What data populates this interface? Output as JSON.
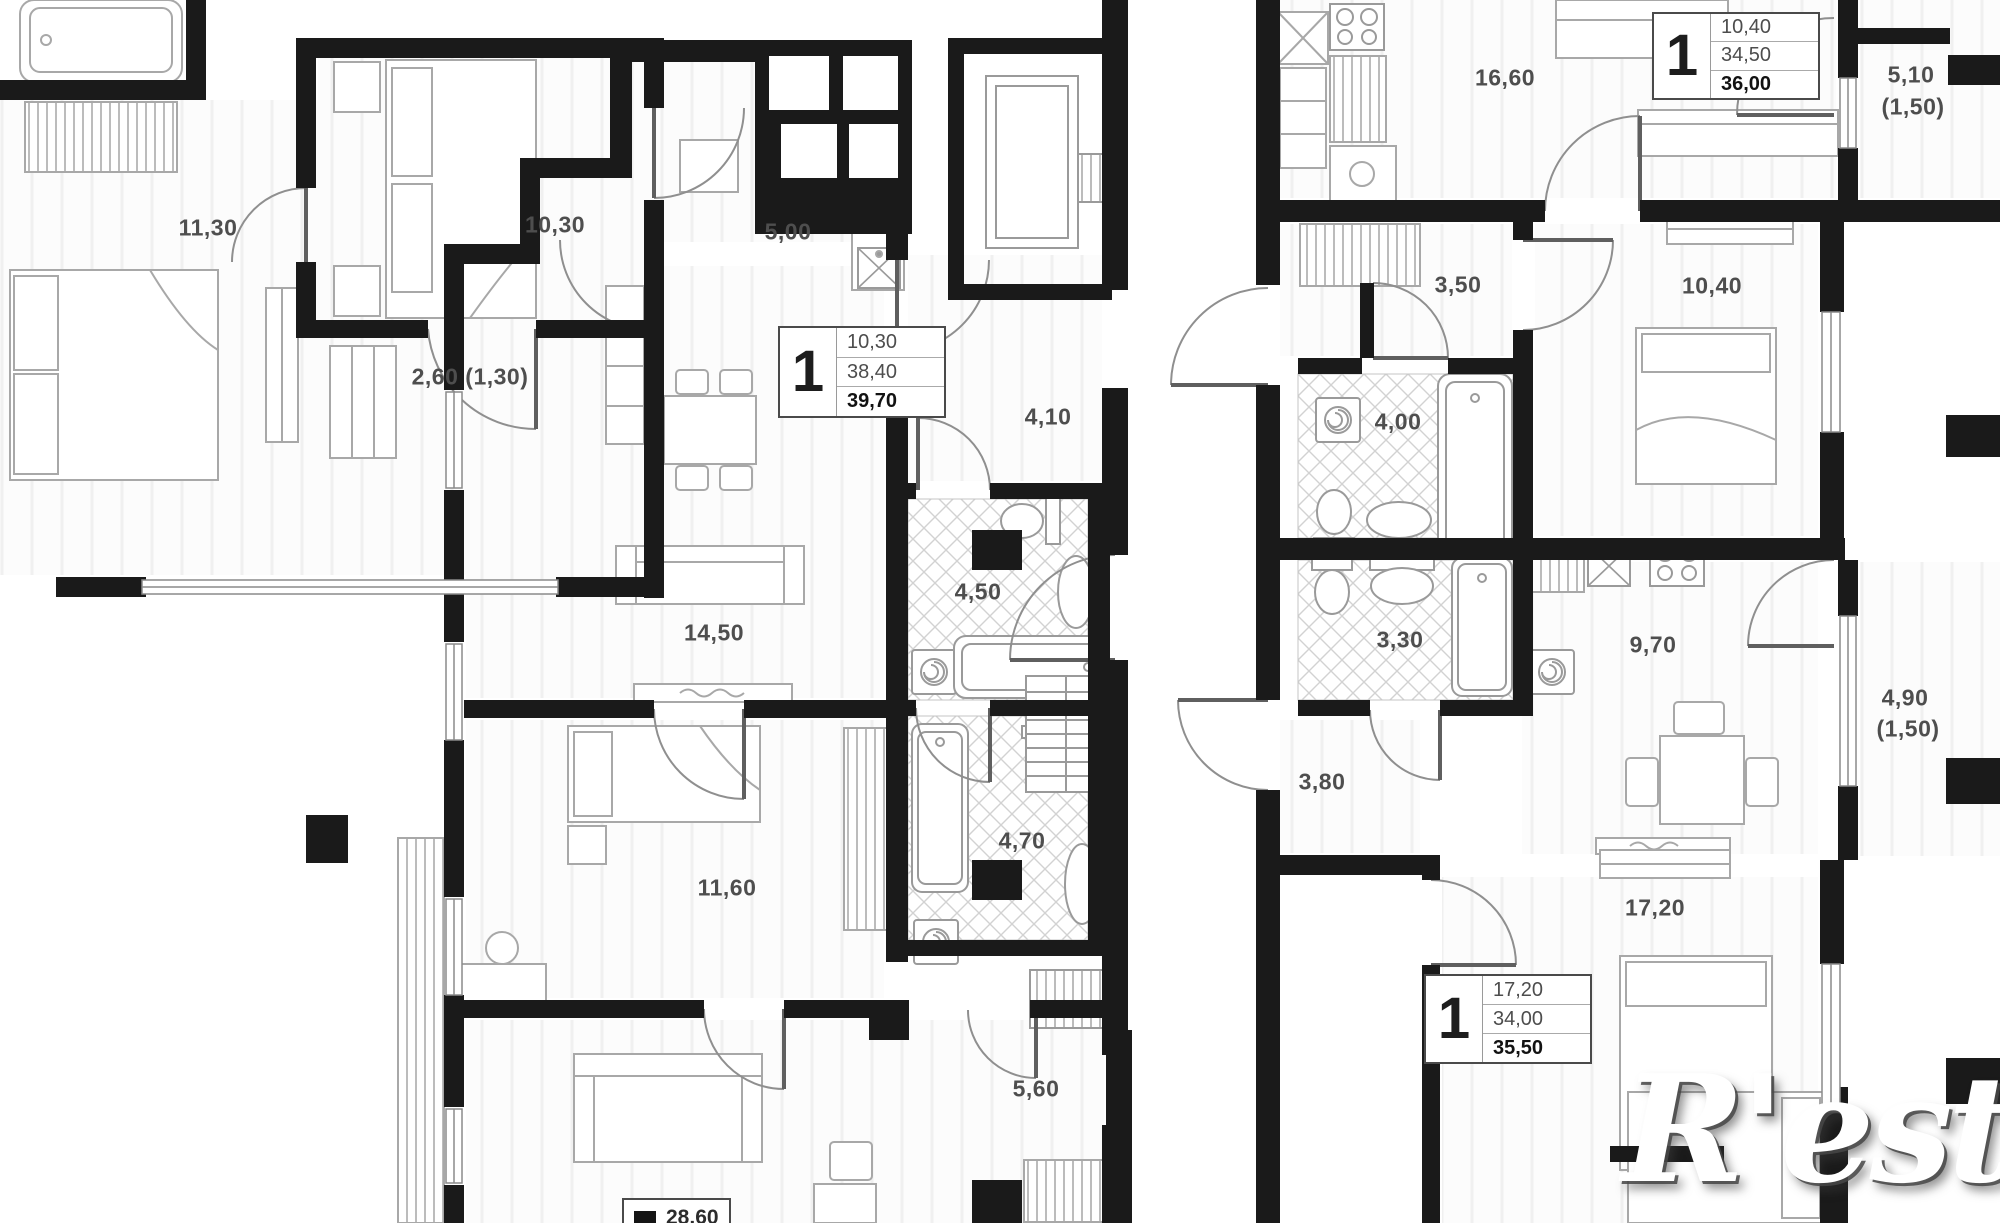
{
  "watermark": {
    "text": "R'estate"
  },
  "colors": {
    "wall": "#1a1a1a",
    "label_text": "#4e4e4e",
    "watermark_fill": "#ffffff"
  },
  "rooms": {
    "labels": [
      "11,30",
      "10,30",
      "2,60 (1,30)",
      "5,00",
      "4,10",
      "4,50",
      "14,50",
      "11,60",
      "4,70",
      "5,60",
      "16,60",
      "5,10",
      "(1,50)",
      "3,50",
      "10,40",
      "4,00",
      "3,30",
      "9,70",
      "4,90",
      "(1,50)",
      "3,80",
      "17,20"
    ]
  },
  "apartments": [
    {
      "rooms_count": "1",
      "living_area": "10,30",
      "area": "38,40",
      "total_area": "39,70"
    },
    {
      "rooms_count": "1",
      "living_area": "10,40",
      "area": "34,50",
      "total_area": "36,00"
    },
    {
      "rooms_count": "1",
      "living_area": "17,20",
      "area": "34,00",
      "total_area": "35,50"
    },
    {
      "total_area": "28,60"
    }
  ]
}
